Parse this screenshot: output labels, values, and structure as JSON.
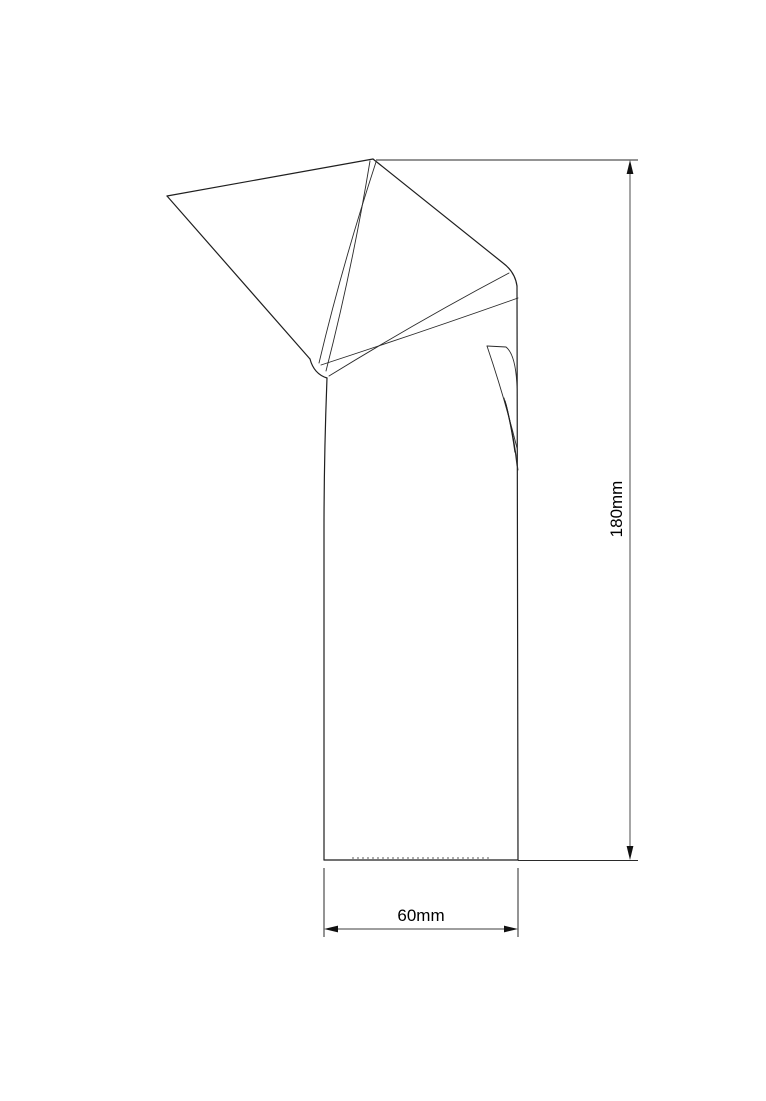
{
  "drawing": {
    "type": "technical-cad-drawing",
    "object": "folded-top rectangular column (perspective line drawing)",
    "dimensions": {
      "height_label": "180mm",
      "width_label": "60mm"
    },
    "colors": {
      "background": "#ffffff",
      "object_line": "#1f1f1f",
      "dimension_line": "#7f7f7f",
      "arrow": "#111111",
      "text": "#000000"
    }
  }
}
